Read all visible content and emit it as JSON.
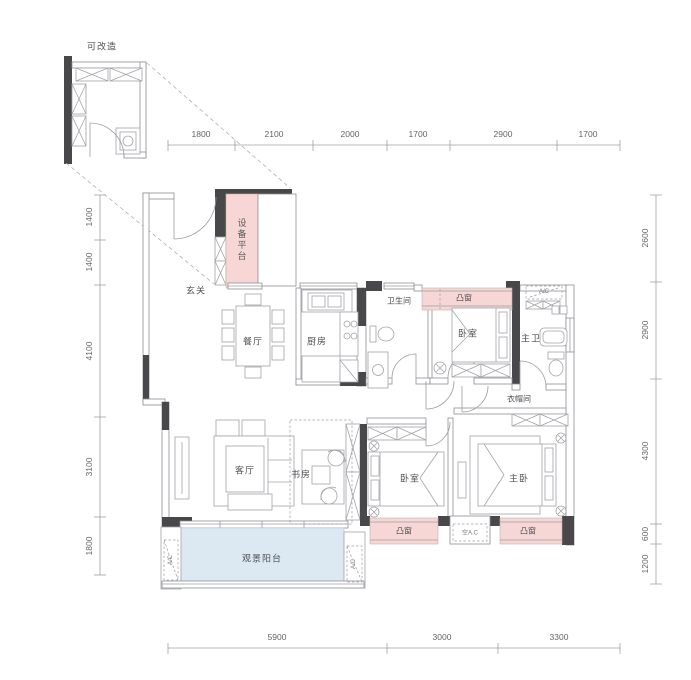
{
  "inset": {
    "title": "可改造"
  },
  "rooms": {
    "entry": "玄关",
    "equipment_platform": "设备平台",
    "dining": "餐厅",
    "kitchen": "厨房",
    "bathroom": "卫生间",
    "bedroom_top": "卧室",
    "master_bath": "主卫",
    "closet": "衣帽间",
    "living": "客厅",
    "study": "书房",
    "bedroom_second": "卧室",
    "master_bedroom": "主卧",
    "balcony": "观景阳台"
  },
  "features": {
    "bay_window_top": "凸窗",
    "bay_window_left": "凸窗",
    "bay_window_right": "凸窗"
  },
  "annotations": {
    "ac_top": "A/C",
    "ac_middle": "空A.C",
    "ac_balcony_left": "A/C",
    "ac_balcony_right": "A/C"
  },
  "dimensions": {
    "top": [
      "1800",
      "2100",
      "2000",
      "1700",
      "2900",
      "1700"
    ],
    "left": [
      "1400",
      "1400",
      "4100",
      "3100",
      "1800"
    ],
    "right": [
      "2600",
      "2900",
      "4300",
      "600",
      "1200"
    ],
    "bottom": [
      "5900",
      "3000",
      "3300"
    ]
  },
  "colors": {
    "wall": "#48484b",
    "bay_window": "#f6d7d5",
    "balcony": "#dde9f2",
    "line": "#9b9ca0"
  }
}
